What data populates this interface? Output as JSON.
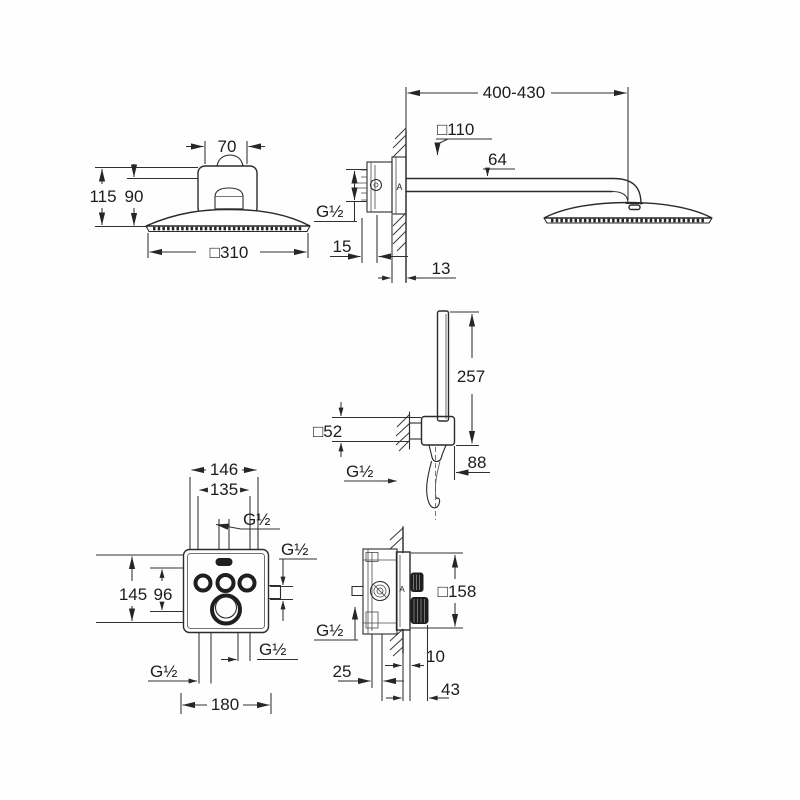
{
  "views": {
    "head_front": {
      "top_width": "70",
      "height_total": "115",
      "height_inner": "90",
      "head_size": "□310"
    },
    "head_side": {
      "arm_length": "400-430",
      "wall_plate": "□110",
      "arm_offset": "64",
      "thread": "G½",
      "plate_depth": "15",
      "wall_offset": "13",
      "marker": "A"
    },
    "hand_shower": {
      "length": "257",
      "bracket_size": "□52",
      "thread": "G½",
      "projection": "88"
    },
    "valve_front": {
      "width_outer": "146",
      "width_inner": "135",
      "thread_top": "G½",
      "thread_right": "G½",
      "height_outer": "145",
      "height_inner": "96",
      "thread_bottom_left": "G½",
      "thread_bottom_right": "G½",
      "width_bottom": "180"
    },
    "valve_side": {
      "plate_size": "□158",
      "thread": "G½",
      "depth_min": "25",
      "plate_offset": "10",
      "total_depth": "43",
      "marker": "A"
    }
  }
}
